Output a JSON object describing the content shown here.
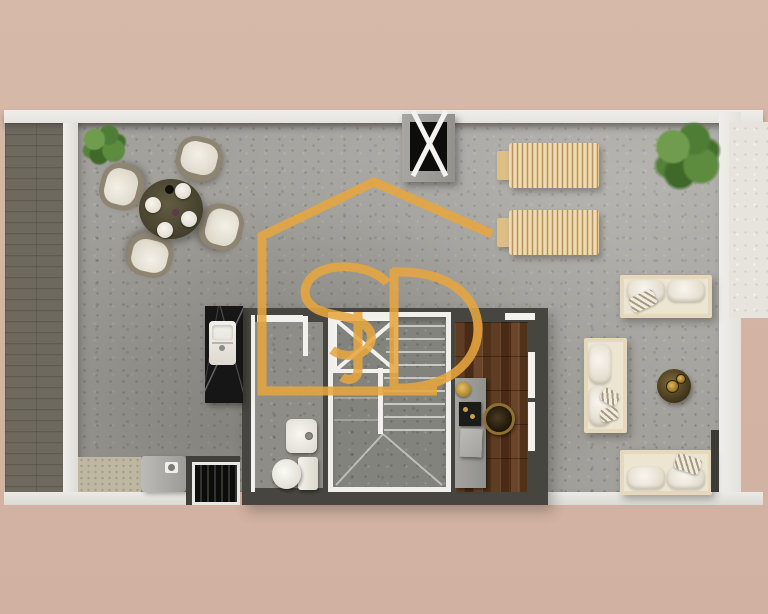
{
  "scene": {
    "kind": "rendered floor plan, top-down view",
    "background_color": "#D4B5A5",
    "wall_color": "#ECEBE7",
    "floor_color": "#A3A19C",
    "core_wall_color": "#46453F",
    "wood_floor_color": "#57371F",
    "terrace_tile_color": "#6E695F"
  },
  "watermark": {
    "text": "SD",
    "shape": "house-outline",
    "color": "#E8A63E"
  },
  "rooms": [
    {
      "name": "left-balcony"
    },
    {
      "name": "main-open-living-area"
    },
    {
      "name": "bathroom"
    },
    {
      "name": "stairwell"
    },
    {
      "name": "entry-hall-wood-floor"
    },
    {
      "name": "right-terrace-strip"
    }
  ],
  "objects": [
    "dining-table-with-four-chairs-and-plates",
    "potted-plant-near-dining",
    "ceiling-shaft-marker-with-x",
    "two-wooden-sun-loungers",
    "potted-plant-top-right",
    "sofa-top-horizontal",
    "sofa-vertical",
    "sofa-bottom-horizontal",
    "round-bronze-coffee-table-with-gold-vessels",
    "kitchen-marble-counter-with-sink",
    "washing-machine",
    "floor-grate",
    "bathroom-sink-vanity",
    "toilet",
    "staircase-with-x-marked-void",
    "entry-console-with-tray-and-basket"
  ]
}
